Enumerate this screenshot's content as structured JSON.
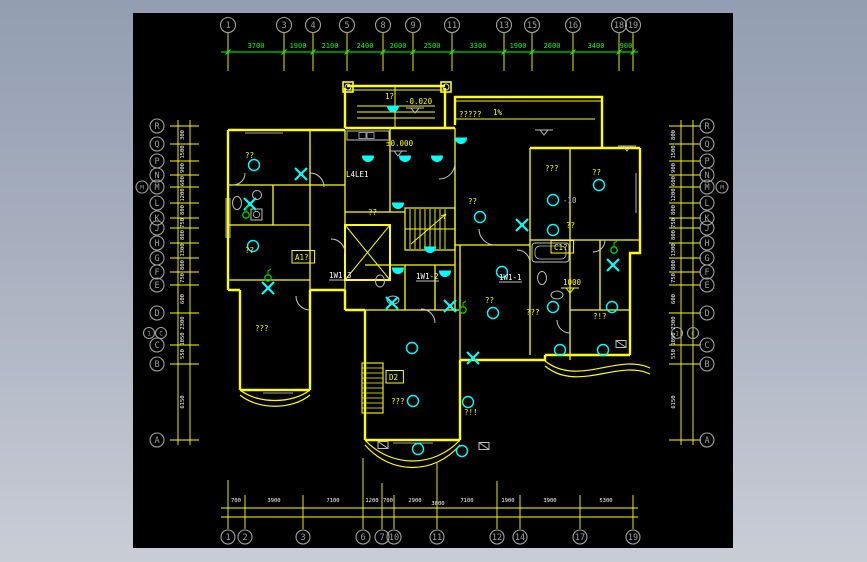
{
  "app": {
    "description": "CAD electrical floor plan drawing",
    "background_top": "#939eb2",
    "background_bottom": "#c9cdd6",
    "canvas_background": "#000000"
  },
  "colors": {
    "wall": "#ffff00",
    "dimension_top": "#00ff00",
    "dimension_small": "#ffffff",
    "symbol_cyan": "#00ffff",
    "symbol_green": "#00cc00",
    "aux_gray": "#bfbfbf",
    "bubble_gray": "#a0a0a0"
  },
  "icons": {
    "ceiling-lamp": "hollow cyan circle",
    "wall-lamp": "solid cyan half-disc",
    "exhaust-fan": "cyan X blades",
    "switch": "green circle with stem",
    "speaker-box": "gray box with diagonal",
    "level-mark": "open triangle with line"
  },
  "axes": {
    "top": {
      "bubbles": [
        {
          "l": "1",
          "x": 95
        },
        {
          "l": "3",
          "x": 151
        },
        {
          "l": "4",
          "x": 180
        },
        {
          "l": "5",
          "x": 214
        },
        {
          "l": "8",
          "x": 250
        },
        {
          "l": "9",
          "x": 280
        },
        {
          "l": "11",
          "x": 319
        },
        {
          "l": "13",
          "x": 371
        },
        {
          "l": "15",
          "x": 399
        },
        {
          "l": "16",
          "x": 440
        },
        {
          "l": "18",
          "x": 486
        },
        {
          "l": "19",
          "x": 500
        }
      ],
      "dims": [
        {
          "t": "3700",
          "x": 123
        },
        {
          "t": "1900",
          "x": 165
        },
        {
          "t": "2100",
          "x": 197
        },
        {
          "t": "2400",
          "x": 232
        },
        {
          "t": "2000",
          "x": 265
        },
        {
          "t": "2500",
          "x": 299
        },
        {
          "t": "3300",
          "x": 345
        },
        {
          "t": "1900",
          "x": 385
        },
        {
          "t": "2600",
          "x": 419
        },
        {
          "t": "3400",
          "x": 463
        },
        {
          "t": "900",
          "x": 493
        }
      ]
    },
    "bottom": {
      "bubbles": [
        {
          "l": "1",
          "x": 95,
          "y1": 467
        },
        {
          "l": "2",
          "x": 112
        },
        {
          "l": "3",
          "x": 170
        },
        {
          "l": "6",
          "x": 230,
          "y1": 445
        },
        {
          "l": "7",
          "x": 249,
          "y1": 470
        },
        {
          "l": "10",
          "x": 261
        },
        {
          "l": "11",
          "x": 304,
          "y1": 450
        },
        {
          "l": "12",
          "x": 364,
          "y1": 468
        },
        {
          "l": "14",
          "x": 387
        },
        {
          "l": "17",
          "x": 447
        },
        {
          "l": "19",
          "x": 500
        }
      ],
      "dims": [
        {
          "t": "700",
          "x": 103
        },
        {
          "t": "3900",
          "x": 141
        },
        {
          "t": "7100",
          "x": 200
        },
        {
          "t": "1200",
          "x": 239
        },
        {
          "t": "700",
          "x": 255
        },
        {
          "t": "2900",
          "x": 282
        },
        {
          "t": "7100",
          "x": 334
        },
        {
          "t": "1900",
          "x": 375
        },
        {
          "t": "3900",
          "x": 417
        },
        {
          "t": "5300",
          "x": 473
        },
        {
          "t": "3000",
          "x": 305,
          "y": 492
        }
      ]
    },
    "left": {
      "bubbles": [
        {
          "l": "R",
          "y": 113
        },
        {
          "l": "Q",
          "y": 131
        },
        {
          "l": "P",
          "y": 148
        },
        {
          "l": "N",
          "y": 162
        },
        {
          "l": "M",
          "y": 174
        },
        {
          "l": "L",
          "y": 190
        },
        {
          "l": "K",
          "y": 205
        },
        {
          "l": "J",
          "y": 215
        },
        {
          "l": "H",
          "y": 230
        },
        {
          "l": "G",
          "y": 245
        },
        {
          "l": "F",
          "y": 259
        },
        {
          "l": "E",
          "y": 272
        },
        {
          "l": "D",
          "y": 300
        },
        {
          "l": "C",
          "y": 332
        },
        {
          "l": "B",
          "y": 351
        },
        {
          "l": "A",
          "y": 427
        },
        {
          "l": "M",
          "x": 9,
          "y": 174,
          "r": 6
        },
        {
          "l": "1",
          "x": 16,
          "y": 320,
          "r": 5.5
        },
        {
          "l": "C",
          "x": 28,
          "y": 320,
          "r": 5.5
        }
      ],
      "dims": [
        {
          "t": "300",
          "y": 122
        },
        {
          "t": "1500",
          "y": 139
        },
        {
          "t": "900",
          "y": 155
        },
        {
          "t": "600",
          "y": 168
        },
        {
          "t": "1200",
          "y": 182
        },
        {
          "t": "800",
          "y": 197
        },
        {
          "t": "750",
          "y": 210
        },
        {
          "t": "800",
          "y": 222
        },
        {
          "t": "1300",
          "y": 237
        },
        {
          "t": "800",
          "y": 252
        },
        {
          "t": "750",
          "y": 265
        },
        {
          "t": "600",
          "y": 286
        },
        {
          "t": "2300",
          "y": 310
        },
        {
          "t": "1050",
          "y": 326
        },
        {
          "t": "550",
          "y": 341
        },
        {
          "t": "6150",
          "y": 389
        }
      ]
    },
    "right": {
      "bubbles": [
        {
          "l": "R",
          "y": 113
        },
        {
          "l": "Q",
          "y": 131
        },
        {
          "l": "P",
          "y": 148
        },
        {
          "l": "N",
          "y": 162
        },
        {
          "l": "M",
          "y": 174
        },
        {
          "l": "L",
          "y": 190
        },
        {
          "l": "K",
          "y": 205
        },
        {
          "l": "J",
          "y": 215
        },
        {
          "l": "H",
          "y": 230
        },
        {
          "l": "G",
          "y": 245
        },
        {
          "l": "F",
          "y": 259
        },
        {
          "l": "E",
          "y": 272
        },
        {
          "l": "D",
          "y": 300
        },
        {
          "l": "C",
          "y": 332
        },
        {
          "l": "B",
          "y": 351
        },
        {
          "l": "A",
          "y": 427
        },
        {
          "l": "M",
          "x": 589,
          "y": 174,
          "r": 6
        },
        {
          "l": "1",
          "x": 544,
          "y": 320,
          "r": 5.5
        },
        {
          "l": "C",
          "x": 560,
          "y": 320,
          "r": 5.5
        }
      ],
      "dims": [
        {
          "t": "800",
          "y": 122
        },
        {
          "t": "1500",
          "y": 139
        },
        {
          "t": "900",
          "y": 155
        },
        {
          "t": "600",
          "y": 168
        },
        {
          "t": "1200",
          "y": 182
        },
        {
          "t": "800",
          "y": 197
        },
        {
          "t": "750",
          "y": 210
        },
        {
          "t": "800",
          "y": 222
        },
        {
          "t": "1300",
          "y": 237
        },
        {
          "t": "800",
          "y": 252
        },
        {
          "t": "750",
          "y": 265
        },
        {
          "t": "600",
          "y": 286
        },
        {
          "t": "2300",
          "y": 310
        },
        {
          "t": "1050",
          "y": 326
        },
        {
          "t": "550",
          "y": 341
        },
        {
          "t": "6150",
          "y": 389
        }
      ]
    }
  },
  "plan": {
    "labels": [
      {
        "t": "1?",
        "x": 252,
        "y": 86,
        "c": "y"
      },
      {
        "t": "-0.020",
        "x": 272,
        "y": 91,
        "c": "y"
      },
      {
        "t": "±0.000",
        "x": 253,
        "y": 133,
        "c": "y"
      },
      {
        "t": "?????",
        "x": 326,
        "y": 104,
        "c": "y"
      },
      {
        "t": "1%",
        "x": 360,
        "y": 102,
        "c": "y"
      },
      {
        "t": "??",
        "x": 112,
        "y": 145,
        "c": "y"
      },
      {
        "t": "??",
        "x": 112,
        "y": 240,
        "c": "y"
      },
      {
        "t": "???",
        "x": 122,
        "y": 318,
        "c": "y"
      },
      {
        "t": "??",
        "x": 235,
        "y": 202,
        "c": "y"
      },
      {
        "t": "??",
        "x": 335,
        "y": 191,
        "c": "y"
      },
      {
        "t": "???",
        "x": 412,
        "y": 158,
        "c": "y"
      },
      {
        "t": "??",
        "x": 459,
        "y": 162,
        "c": "y"
      },
      {
        "t": "??",
        "x": 433,
        "y": 215,
        "c": "y"
      },
      {
        "t": "??",
        "x": 352,
        "y": 290,
        "c": "y"
      },
      {
        "t": "???",
        "x": 393,
        "y": 302,
        "c": "y"
      },
      {
        "t": "?!?",
        "x": 460,
        "y": 306,
        "c": "y"
      },
      {
        "t": "???",
        "x": 258,
        "y": 391,
        "c": "y"
      },
      {
        "t": "?!!",
        "x": 331,
        "y": 402,
        "c": "y"
      },
      {
        "t": "1000",
        "x": 430,
        "y": 272,
        "c": "y"
      },
      {
        "t": "A1?",
        "x": 162,
        "y": 247,
        "c": "y",
        "box": true
      },
      {
        "t": "C1?",
        "x": 421,
        "y": 237,
        "c": "y",
        "box": true
      },
      {
        "t": "D2",
        "x": 256,
        "y": 367,
        "c": "y",
        "box": true
      },
      {
        "t": "1W1-3",
        "x": 196,
        "y": 265,
        "c": "w",
        "ul": true
      },
      {
        "t": "1W1-2",
        "x": 283,
        "y": 266,
        "c": "w",
        "ul": true
      },
      {
        "t": "1W1-1",
        "x": 366,
        "y": 267,
        "c": "w",
        "ul": true
      },
      {
        "t": "L4LE1",
        "x": 213,
        "y": 164,
        "c": "w"
      },
      {
        "t": "-10",
        "x": 430,
        "y": 190,
        "c": "g"
      }
    ],
    "symbols": [
      {
        "k": "ceiling-lamp",
        "x": 121,
        "y": 152
      },
      {
        "k": "ceiling-lamp",
        "x": 120,
        "y": 233
      },
      {
        "k": "ceiling-lamp",
        "x": 347,
        "y": 204
      },
      {
        "k": "ceiling-lamp",
        "x": 369,
        "y": 259
      },
      {
        "k": "ceiling-lamp",
        "x": 420,
        "y": 187
      },
      {
        "k": "ceiling-lamp",
        "x": 420,
        "y": 217
      },
      {
        "k": "ceiling-lamp",
        "x": 466,
        "y": 172
      },
      {
        "k": "ceiling-lamp",
        "x": 360,
        "y": 300
      },
      {
        "k": "ceiling-lamp",
        "x": 420,
        "y": 294
      },
      {
        "k": "ceiling-lamp",
        "x": 479,
        "y": 294
      },
      {
        "k": "ceiling-lamp",
        "x": 279,
        "y": 335
      },
      {
        "k": "ceiling-lamp",
        "x": 280,
        "y": 388
      },
      {
        "k": "ceiling-lamp",
        "x": 335,
        "y": 389
      },
      {
        "k": "ceiling-lamp",
        "x": 285,
        "y": 436
      },
      {
        "k": "ceiling-lamp",
        "x": 329,
        "y": 438
      },
      {
        "k": "ceiling-lamp",
        "x": 427,
        "y": 337
      },
      {
        "k": "ceiling-lamp",
        "x": 470,
        "y": 337
      },
      {
        "k": "wall-lamp",
        "x": 260,
        "y": 93
      },
      {
        "k": "wall-lamp",
        "x": 235,
        "y": 143
      },
      {
        "k": "wall-lamp",
        "x": 272,
        "y": 143
      },
      {
        "k": "wall-lamp",
        "x": 304,
        "y": 143
      },
      {
        "k": "wall-lamp",
        "x": 328,
        "y": 125
      },
      {
        "k": "wall-lamp",
        "x": 265,
        "y": 190
      },
      {
        "k": "wall-lamp",
        "x": 297,
        "y": 234
      },
      {
        "k": "wall-lamp",
        "x": 265,
        "y": 255
      },
      {
        "k": "wall-lamp",
        "x": 312,
        "y": 258
      },
      {
        "k": "exhaust-fan",
        "x": 168,
        "y": 161
      },
      {
        "k": "exhaust-fan",
        "x": 117,
        "y": 191
      },
      {
        "k": "exhaust-fan",
        "x": 135,
        "y": 275
      },
      {
        "k": "exhaust-fan",
        "x": 389,
        "y": 212
      },
      {
        "k": "exhaust-fan",
        "x": 259,
        "y": 290
      },
      {
        "k": "exhaust-fan",
        "x": 317,
        "y": 293
      },
      {
        "k": "exhaust-fan",
        "x": 480,
        "y": 252
      },
      {
        "k": "exhaust-fan",
        "x": 340,
        "y": 345
      },
      {
        "k": "switch",
        "x": 113,
        "y": 202
      },
      {
        "k": "switch",
        "x": 135,
        "y": 265
      },
      {
        "k": "switch",
        "x": 330,
        "y": 297
      },
      {
        "k": "switch",
        "x": 481,
        "y": 237
      },
      {
        "k": "speaker-box",
        "x": 250,
        "y": 432
      },
      {
        "k": "speaker-box",
        "x": 351,
        "y": 433
      },
      {
        "k": "speaker-box",
        "x": 488,
        "y": 331
      },
      {
        "k": "level-mark",
        "x": 282,
        "y": 99
      },
      {
        "k": "level-mark",
        "x": 265,
        "y": 142
      },
      {
        "k": "level-mark",
        "x": 411,
        "y": 121
      },
      {
        "k": "level-mark",
        "x": 494,
        "y": 137
      },
      {
        "k": "level-mark-y",
        "x": 437,
        "y": 279
      }
    ]
  }
}
